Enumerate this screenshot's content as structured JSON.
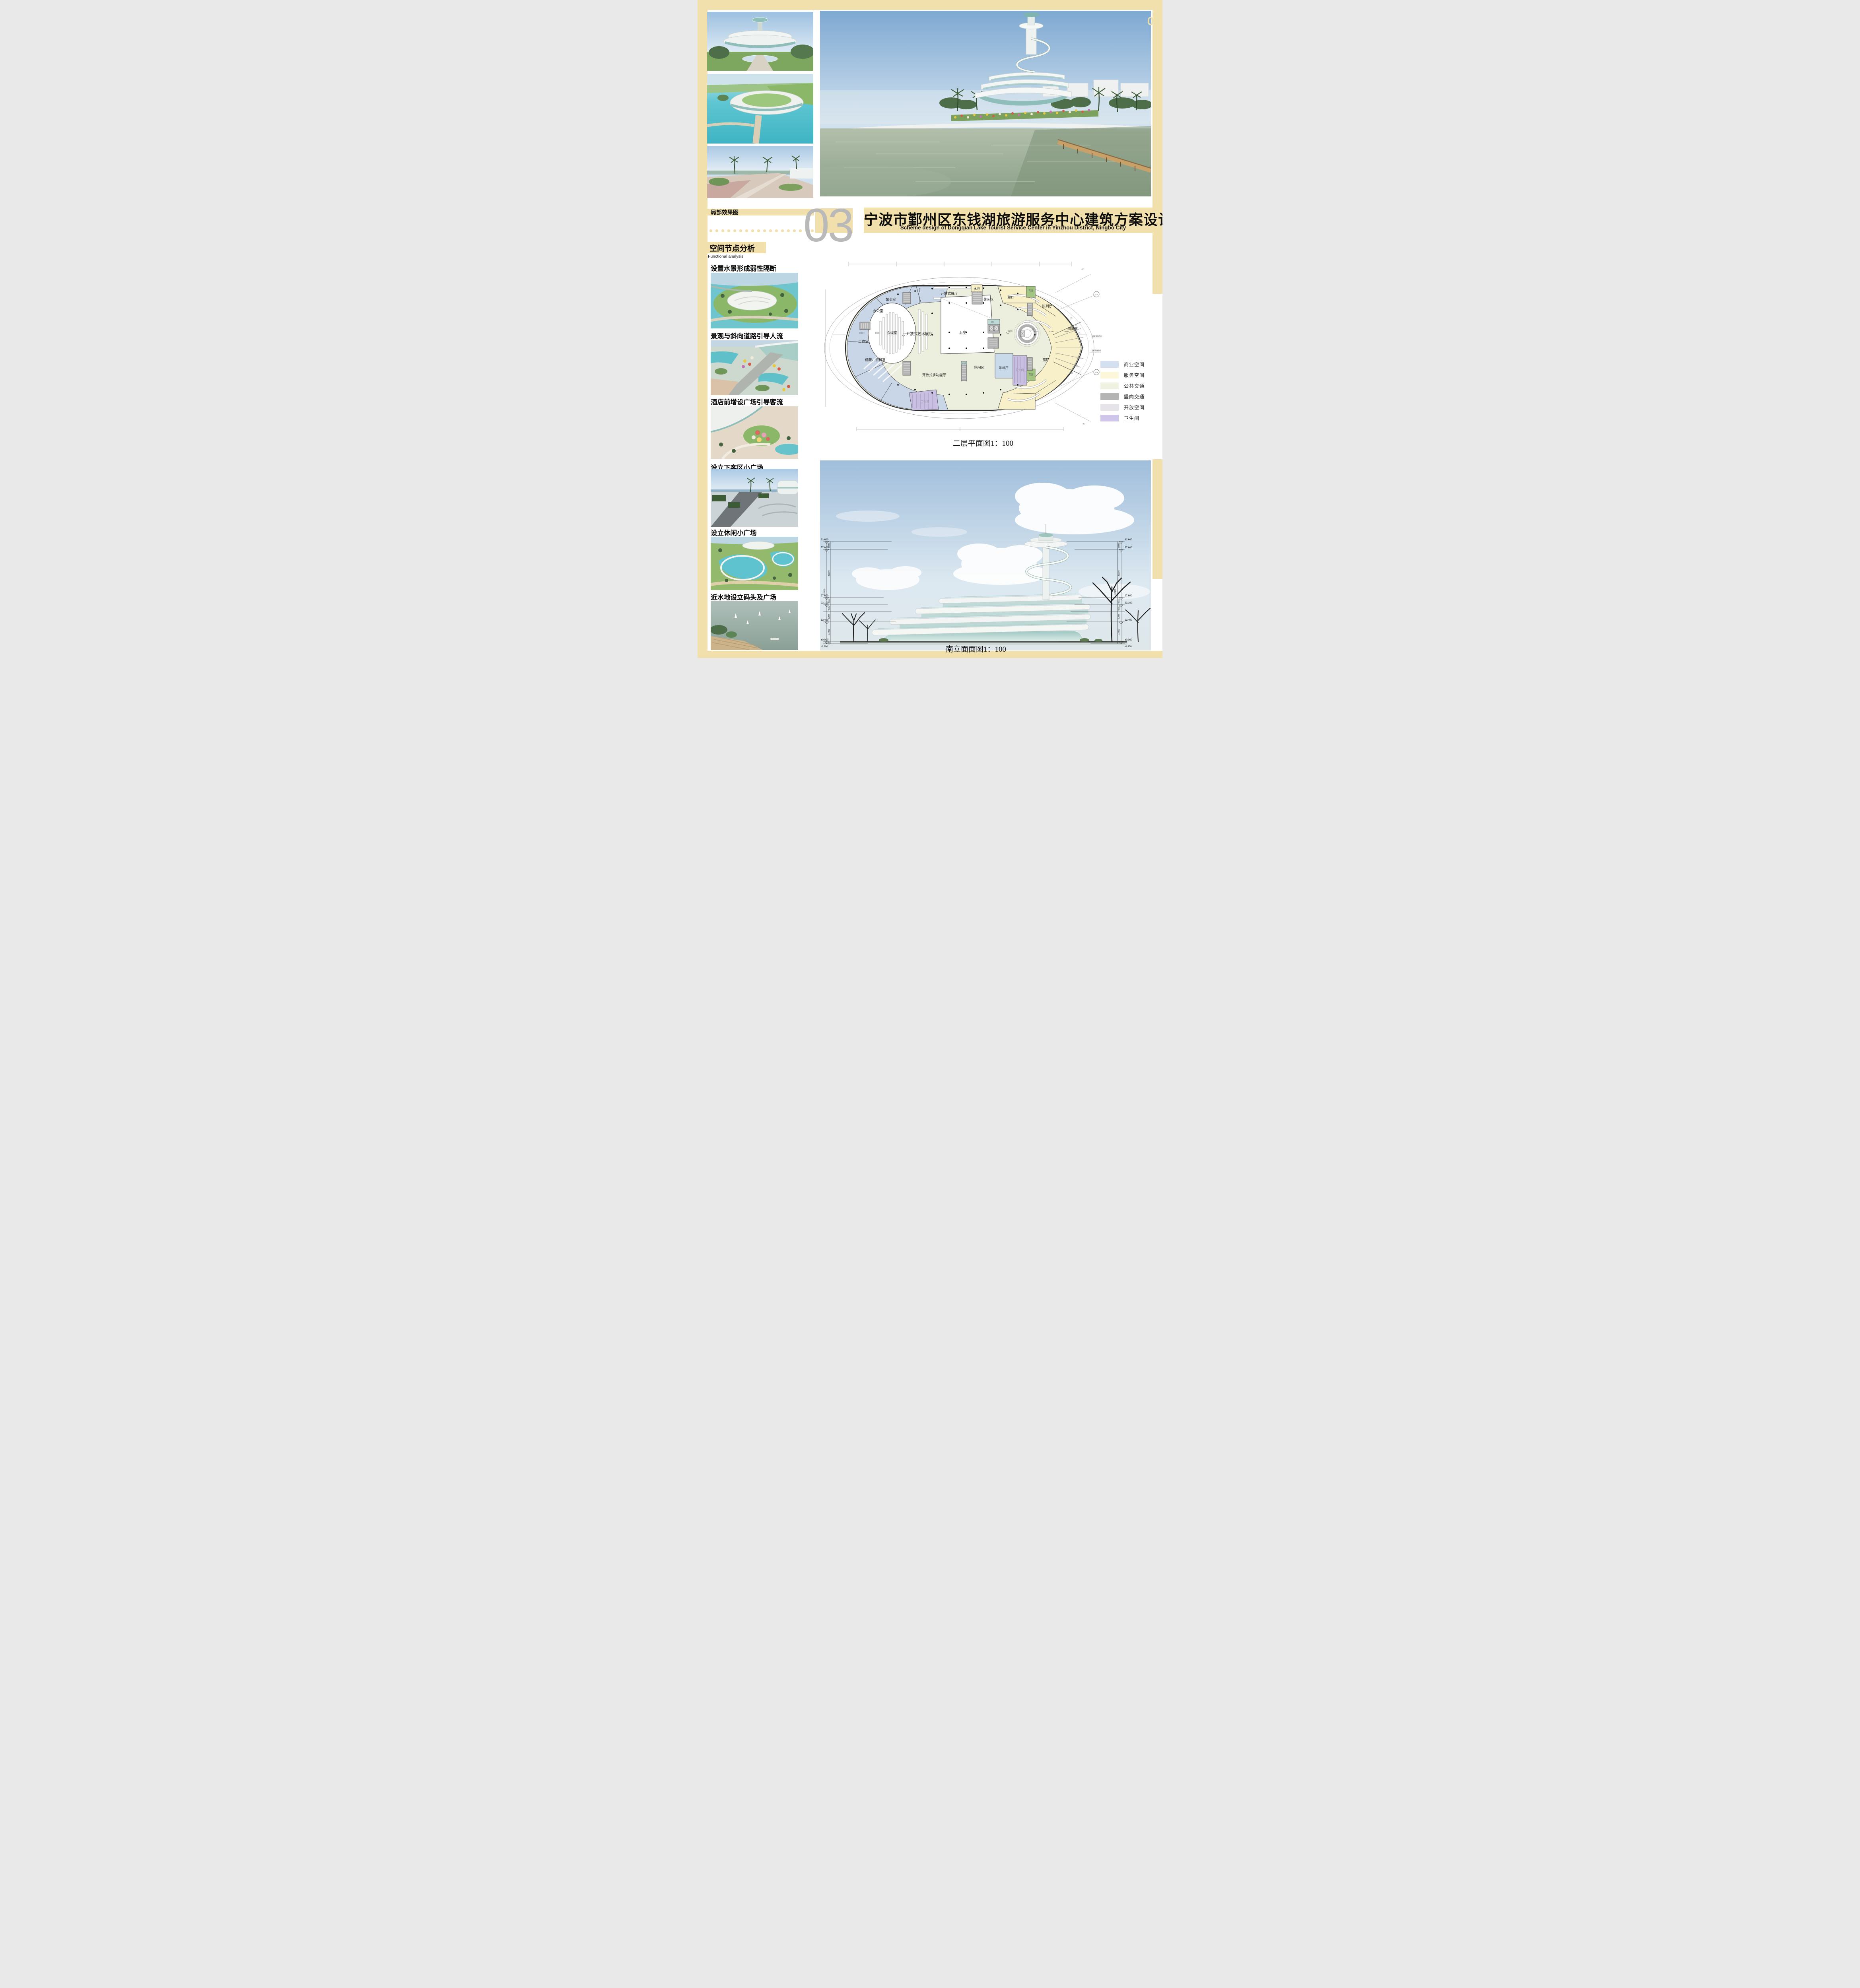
{
  "page": {
    "accent_color": "#f2e0ac",
    "corner_number": "03"
  },
  "header": {
    "title_cn": "宁波市鄞州区东钱湖旅游服务中心建筑方案设计",
    "title_en": "Scheme design of Dongqian Lake Tourist Service Center in Yinzhou District, Ningbo City"
  },
  "left": {
    "section_renders": "局部效果图",
    "big_number": "03",
    "section_analysis": "空间节点分析",
    "section_analysis_en": "Functional analysis",
    "items": [
      {
        "label": "设置水景形成弱性隔断"
      },
      {
        "label": "景观与斜向道路引导人流"
      },
      {
        "label": "酒店前增设广场引导客流"
      },
      {
        "label": "设立下客区小广场"
      },
      {
        "label": "设立休闲小广场"
      },
      {
        "label": "近水地设立码头及广场"
      }
    ]
  },
  "plan": {
    "caption": "二层平面图1：100",
    "rooms": {
      "guanzhangshi": "馆长室",
      "bangongshi": "办公室",
      "huiyishi": "会议室",
      "gongzuoshi": "工作室",
      "chucang": "储藏、资料室",
      "wc_left": "卫生间",
      "art_hall": "开放式艺术展厅",
      "open_hall": "开放式展厅",
      "shuiba": "水吧",
      "xiuxian_top": "休闲区",
      "zhanting_top": "展厅",
      "shangkong": "上空",
      "chenlieting": "陈列厅",
      "yuelanshi": "阅览室",
      "shangkong_ramp": "上空",
      "zhanting_bottom": "展厅",
      "huayuan_top": "花园",
      "huayuan_bottom": "花园",
      "kafeiting": "咖啡厅",
      "wc_right": "卫生间",
      "xiuxian_bottom": "休闲区",
      "duogongneng": "开放式多功能厅",
      "zawujian": "杂物间",
      "shebei": "设备"
    },
    "levels": {
      "l1": "6.200",
      "l2": "6.200"
    },
    "dims": {
      "d1": "9600",
      "d2": "9600",
      "d3": "9600",
      "d4": "9420",
      "d5": "9790",
      "d6": "9600",
      "v1": "9600",
      "v2": "9600"
    },
    "grid": {
      "b1": "J-2",
      "b2": "J-4",
      "a1": "30°",
      "a2": "30°",
      "note1": "三层屋顶挑檐线",
      "note2": "二层屋顶挑檐线"
    },
    "legend": [
      {
        "label": "商业空间",
        "color": "#d4e0f0"
      },
      {
        "label": "服务空间",
        "color": "#fbf7d8"
      },
      {
        "label": "公共交通",
        "color": "#eff2e1"
      },
      {
        "label": "竖向交通",
        "color": "#b4b4b4"
      },
      {
        "label": "开放空间",
        "color": "#e7e4e9"
      },
      {
        "label": "卫生间",
        "color": "#d0c6ea"
      }
    ]
  },
  "elevation": {
    "caption": "南立面面图1：100",
    "levels": {
      "lv1": "62.600",
      "lv2": "57.600",
      "lv3": "27.600",
      "lv4": "23.100",
      "lv5": "12.400",
      "lv6": "±0.000",
      "lv7": "-0.300"
    },
    "dims": {
      "s1": "5000",
      "s2": "30000",
      "s3": "4500",
      "s4": "4500",
      "s5": "6200",
      "s6": "12400",
      "s7": "300",
      "total": "62900"
    }
  }
}
